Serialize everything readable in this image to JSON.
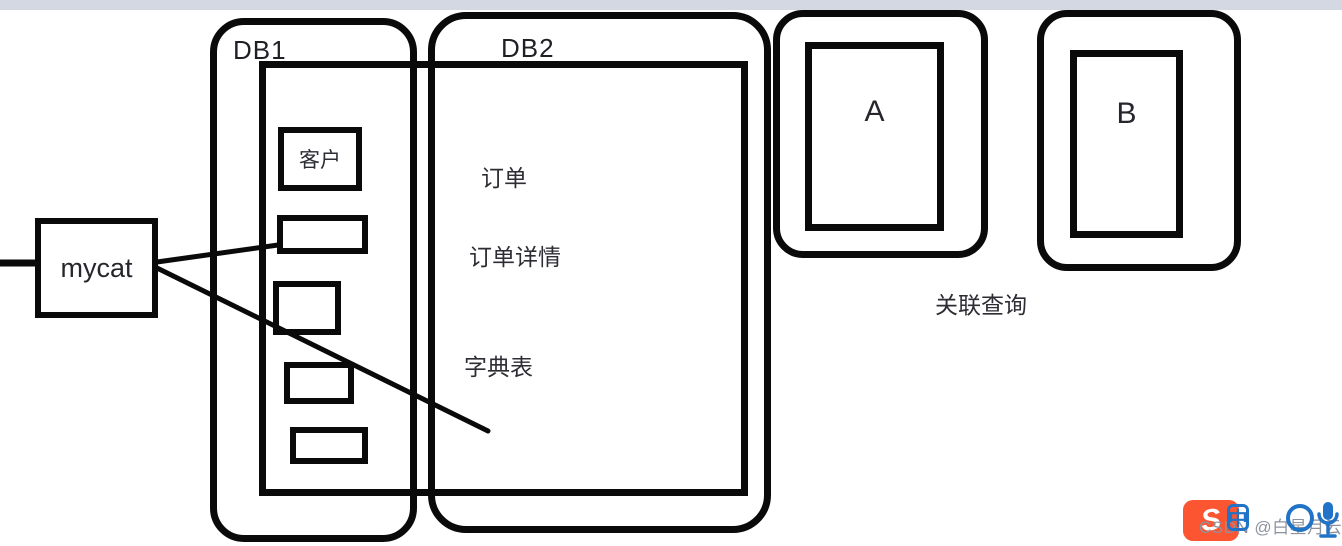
{
  "colors": {
    "stroke": "#0a0a0a",
    "top_strip": "#d4d8e3",
    "label_text": "#26262e",
    "watermark_orange": "#fb5531",
    "watermark_blue": "#2173c8",
    "watermark_gray": "#8d939e"
  },
  "diagram": {
    "mycat_label": "mycat",
    "db1": {
      "label": "DB1",
      "customer_box_label": "客户"
    },
    "db2": {
      "label": "DB2",
      "tables": [
        "订单",
        "订单详情",
        "字典表"
      ]
    },
    "node_a_label": "A",
    "node_b_label": "B",
    "caption": "关联查询"
  },
  "watermark": {
    "logo_glyph": "S",
    "text": "CSDN @白星月云",
    "zhong_label": "中",
    "icons": [
      "csdn-logo",
      "zhong-badge",
      "circle-badge",
      "microphone"
    ]
  }
}
